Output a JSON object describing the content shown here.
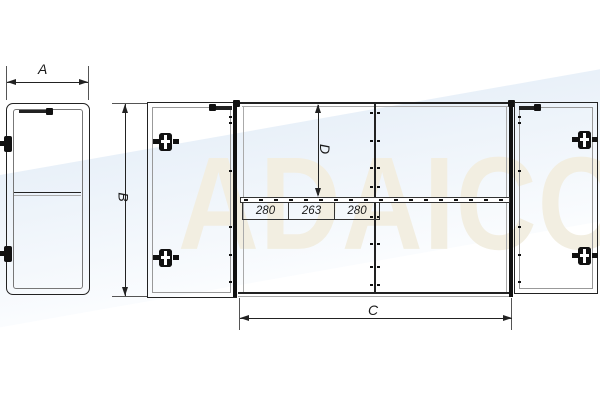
{
  "watermark": {
    "text": "ADAICO"
  },
  "dimensions": {
    "width_label": "A",
    "height_label": "B",
    "inner_width_label": "C",
    "depth_label": "D",
    "rail_segments": [
      {
        "value": "280"
      },
      {
        "value": "263"
      },
      {
        "value": "280"
      }
    ]
  },
  "icons": {
    "hinge": "hinge-icon",
    "latch": "latch-icon"
  },
  "colors": {
    "line": "#222222",
    "dim_line": "#555555",
    "watermark_text": "#f2eee1",
    "watermark_band": "#cedff1",
    "background": "#ffffff"
  }
}
